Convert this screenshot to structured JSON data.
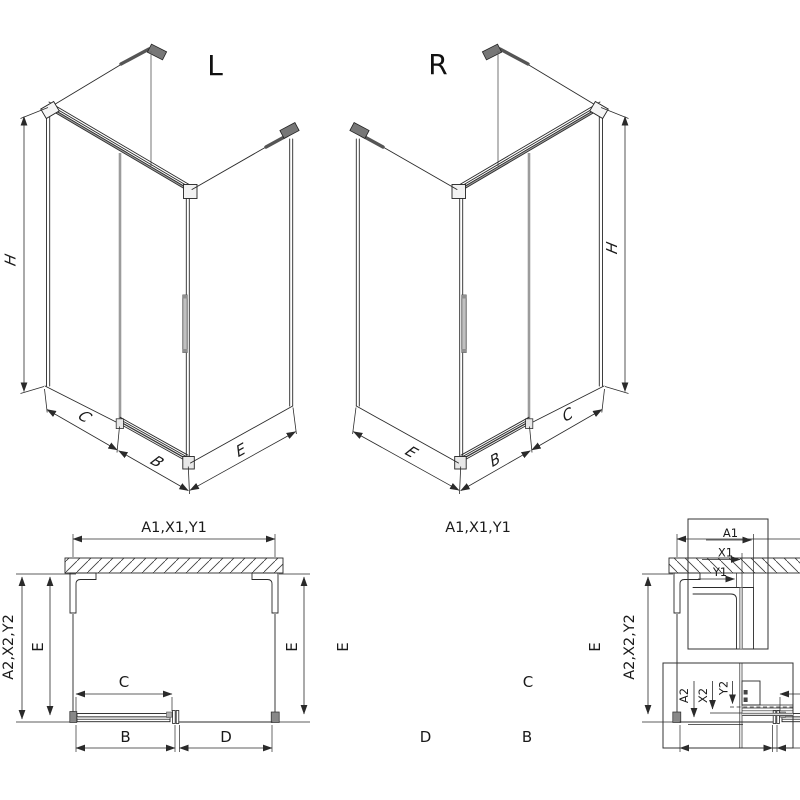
{
  "diagram": {
    "iso_left": {
      "title": "L",
      "dim_h": "H",
      "dim_c": "C",
      "dim_b": "B",
      "dim_e": "E"
    },
    "iso_right": {
      "title": "R",
      "dim_h": "H",
      "dim_c": "C",
      "dim_b": "B",
      "dim_e": "E"
    },
    "plan_left": {
      "dim_top": "A1,X1,Y1",
      "dim_side": "A2,X2,Y2",
      "dim_e_left": "E",
      "dim_e_right": "E",
      "dim_c": "C",
      "dim_b": "B",
      "dim_d": "D"
    },
    "plan_right": {
      "dim_top": "A1,X1,Y1",
      "dim_side": "A2,X2,Y2",
      "dim_e_left": "E",
      "dim_e_right": "E",
      "dim_c": "C",
      "dim_b": "B",
      "dim_d": "D"
    },
    "detail_top": {
      "dim_a": "A1",
      "dim_x": "X1",
      "dim_y": "Y1"
    },
    "detail_bottom": {
      "dim_a": "A2",
      "dim_x": "X2",
      "dim_y": "Y2"
    },
    "colors": {
      "line": "#2a2a2a",
      "glass_gray": "#9c9c9c",
      "rail_gray": "#b3b3b3",
      "handle": "#c0c0c0"
    }
  }
}
